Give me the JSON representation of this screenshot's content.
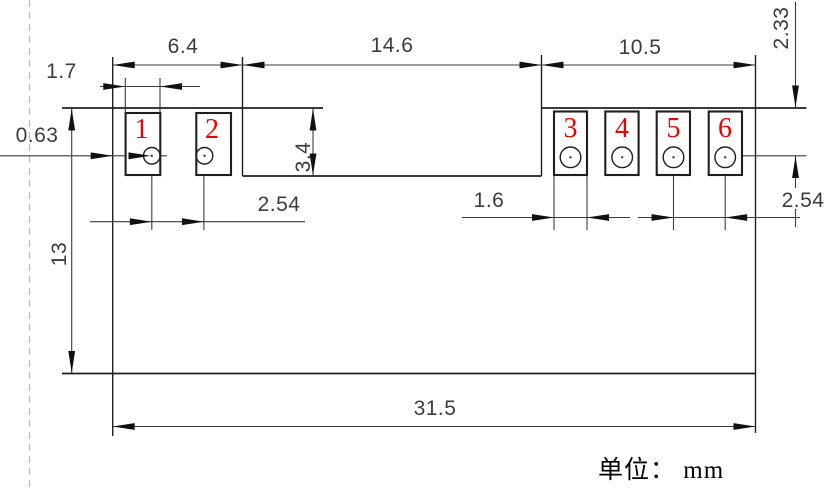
{
  "drawing": {
    "unit_note": "单位： mm",
    "canvas": {
      "w": 836,
      "h": 490,
      "bg": "#ffffff"
    },
    "colors": {
      "feature": "#1f1f1f",
      "dim": "#3c3c3c",
      "arrow": "#111111",
      "pad_number_red": "#ee0000",
      "dashed": "#b4b4b4",
      "text": "#3c3c3c"
    },
    "pads": [
      {
        "num": "1",
        "x": 125.6,
        "y": 113,
        "w": 34.7,
        "h": 62,
        "hole": {
          "cx": 151.8,
          "cy": 155.8,
          "r": 8.3
        },
        "num_x": 141.5,
        "num_y": 138
      },
      {
        "num": "2",
        "x": 196.3,
        "y": 113,
        "w": 34.7,
        "h": 62,
        "hole": {
          "cx": 204.5,
          "cy": 155.8,
          "r": 8.3
        },
        "num_x": 212,
        "num_y": 138
      },
      {
        "num": "3",
        "x": 554,
        "y": 111.5,
        "w": 33,
        "h": 63.5,
        "hole": {
          "cx": 570.5,
          "cy": 157.3,
          "r": 10.3
        },
        "num_x": 570.5,
        "num_y": 137
      },
      {
        "num": "4",
        "x": 605.3,
        "y": 111.5,
        "w": 33.3,
        "h": 63.5,
        "hole": {
          "cx": 622.2,
          "cy": 157.3,
          "r": 10.3
        },
        "num_x": 622,
        "num_y": 137
      },
      {
        "num": "5",
        "x": 656.7,
        "y": 111.5,
        "w": 33.3,
        "h": 63.5,
        "hole": {
          "cx": 673.5,
          "cy": 157.3,
          "r": 10.3
        },
        "num_x": 673.5,
        "num_y": 137
      },
      {
        "num": "6",
        "x": 708.7,
        "y": 111.5,
        "w": 33.3,
        "h": 63.5,
        "hole": {
          "cx": 725.2,
          "cy": 157.3,
          "r": 10.3
        },
        "num_x": 725,
        "num_y": 137
      }
    ],
    "lines": [
      {
        "n": "phantom-centerline",
        "x1": 29.5,
        "y1": 0,
        "x2": 29.5,
        "y2": 490,
        "w": 1,
        "c": "dashed",
        "dash": [
          7,
          5
        ]
      },
      {
        "n": "body-top-edge-left",
        "x1": 62,
        "y1": 108,
        "x2": 323,
        "y2": 108,
        "w": 1.7,
        "c": "feature"
      },
      {
        "n": "body-top-edge-right",
        "x1": 541.5,
        "y1": 108,
        "x2": 806.5,
        "y2": 108,
        "w": 1.7,
        "c": "feature"
      },
      {
        "n": "body-left-edge",
        "x1": 112.7,
        "y1": 57,
        "x2": 112.7,
        "y2": 436,
        "w": 1.4,
        "c": "feature"
      },
      {
        "n": "body-right-edge",
        "x1": 755.5,
        "y1": 55,
        "x2": 755.5,
        "y2": 433,
        "w": 1.4,
        "c": "feature"
      },
      {
        "n": "body-bottom-edge",
        "x1": 62,
        "y1": 373.5,
        "x2": 755.5,
        "y2": 373.5,
        "w": 1.7,
        "c": "feature"
      },
      {
        "n": "center-slot-left-edge",
        "x1": 242.5,
        "y1": 57,
        "x2": 242.5,
        "y2": 176,
        "w": 1.4,
        "c": "feature"
      },
      {
        "n": "center-slot-right-edge",
        "x1": 541.5,
        "y1": 55,
        "x2": 541.5,
        "y2": 176,
        "w": 1.4,
        "c": "feature"
      },
      {
        "n": "center-slot-bottom-edge",
        "x1": 242.5,
        "y1": 176,
        "x2": 541.5,
        "y2": 176,
        "w": 1.7,
        "c": "feature"
      },
      {
        "n": "dim-line-top-row",
        "x1": 112.7,
        "y1": 65,
        "x2": 755.5,
        "y2": 65,
        "w": 1.1,
        "c": "dim"
      },
      {
        "n": "dim-line-1.7",
        "x1": 100,
        "y1": 86.5,
        "x2": 200,
        "y2": 86.5,
        "w": 1.1,
        "c": "dim"
      },
      {
        "n": "ext-line-pad1-left",
        "x1": 125.3,
        "y1": 78,
        "x2": 125.3,
        "y2": 112,
        "w": 1.1,
        "c": "dim"
      },
      {
        "n": "ext-line-pad1-right",
        "x1": 160,
        "y1": 78,
        "x2": 160,
        "y2": 112,
        "w": 1.1,
        "c": "dim"
      },
      {
        "n": "leader-line-0.63",
        "x1": 0,
        "y1": 155.8,
        "x2": 167,
        "y2": 155.8,
        "w": 1.1,
        "c": "dim"
      },
      {
        "n": "hole6-center-hline",
        "x1": 725,
        "y1": 155.8,
        "x2": 806.5,
        "y2": 155.8,
        "w": 1.1,
        "c": "dim"
      },
      {
        "n": "dim-line-2.33",
        "x1": 795.5,
        "y1": 2,
        "x2": 795.5,
        "y2": 107.5,
        "w": 1.1,
        "c": "dim"
      },
      {
        "n": "dim-line-2.54-right-a",
        "x1": 795.5,
        "y1": 156,
        "x2": 795.5,
        "y2": 188,
        "w": 1.1,
        "c": "dim"
      },
      {
        "n": "dim-line-2.54-right-b",
        "x1": 795.5,
        "y1": 209,
        "x2": 795.5,
        "y2": 227,
        "w": 1.1,
        "c": "dim"
      },
      {
        "n": "dim-line-13",
        "x1": 71.7,
        "y1": 108.5,
        "x2": 71.7,
        "y2": 373,
        "w": 1.1,
        "c": "dim"
      },
      {
        "n": "dim-line-3.4",
        "x1": 313,
        "y1": 108,
        "x2": 313,
        "y2": 175.5,
        "w": 1.1,
        "c": "dim"
      },
      {
        "n": "dim-line-2.54-left",
        "x1": 90,
        "y1": 221.7,
        "x2": 305,
        "y2": 221.7,
        "w": 1.1,
        "c": "dim"
      },
      {
        "n": "hole1-centerline",
        "x1": 151.8,
        "y1": 147,
        "x2": 151.8,
        "y2": 230,
        "w": 1.1,
        "c": "dim"
      },
      {
        "n": "hole2-centerline",
        "x1": 203.9,
        "y1": 147,
        "x2": 203.9,
        "y2": 230,
        "w": 1.1,
        "c": "dim"
      },
      {
        "n": "dim-line-1.6",
        "x1": 462,
        "y1": 217.5,
        "x2": 630,
        "y2": 217.5,
        "w": 1.1,
        "c": "dim"
      },
      {
        "n": "ext-line-pad3-left",
        "x1": 554,
        "y1": 176,
        "x2": 554,
        "y2": 230,
        "w": 1.1,
        "c": "dim"
      },
      {
        "n": "ext-line-pad3-right",
        "x1": 587,
        "y1": 176,
        "x2": 587,
        "y2": 230,
        "w": 1.1,
        "c": "dim"
      },
      {
        "n": "dim-line-2.54-pitch",
        "x1": 638,
        "y1": 217.5,
        "x2": 800,
        "y2": 217.5,
        "w": 1.1,
        "c": "dim"
      },
      {
        "n": "hole5-centerline",
        "x1": 673.5,
        "y1": 170,
        "x2": 673.5,
        "y2": 230,
        "w": 1.1,
        "c": "dim"
      },
      {
        "n": "hole6-centerline",
        "x1": 725.2,
        "y1": 170,
        "x2": 725.2,
        "y2": 230,
        "w": 1.1,
        "c": "dim"
      },
      {
        "n": "dim-line-31.5",
        "x1": 112.7,
        "y1": 426.5,
        "x2": 755.5,
        "y2": 426.5,
        "w": 1.1,
        "c": "dim"
      }
    ],
    "arrows": [
      {
        "n": "arrow-6.4-left",
        "x": 112.7,
        "y": 65,
        "dir": "l"
      },
      {
        "n": "arrow-6.4-right",
        "x": 242.5,
        "y": 65,
        "dir": "r"
      },
      {
        "n": "arrow-14.6-left",
        "x": 242.5,
        "y": 65,
        "dir": "l"
      },
      {
        "n": "arrow-14.6-right",
        "x": 541.5,
        "y": 65,
        "dir": "r"
      },
      {
        "n": "arrow-10.5-left",
        "x": 541.5,
        "y": 65,
        "dir": "l"
      },
      {
        "n": "arrow-10.5-right",
        "x": 755.5,
        "y": 65,
        "dir": "r"
      },
      {
        "n": "arrow-1.7-left",
        "x": 125.3,
        "y": 86.5,
        "dir": "r"
      },
      {
        "n": "arrow-1.7-right",
        "x": 160,
        "y": 86.5,
        "dir": "l"
      },
      {
        "n": "arrow-0.63-a",
        "x": 112.7,
        "y": 155.8,
        "dir": "r"
      },
      {
        "n": "arrow-0.63-b",
        "x": 150.5,
        "y": 155.8,
        "dir": "r"
      },
      {
        "n": "arrow-2.33-down",
        "x": 795.5,
        "y": 107.5,
        "dir": "d"
      },
      {
        "n": "arrow-2.54-right-up",
        "x": 795.5,
        "y": 156,
        "dir": "u"
      },
      {
        "n": "arrow-13-top",
        "x": 71.7,
        "y": 108.5,
        "dir": "u"
      },
      {
        "n": "arrow-13-bottom",
        "x": 71.7,
        "y": 373,
        "dir": "d"
      },
      {
        "n": "arrow-3.4-top",
        "x": 313,
        "y": 108.5,
        "dir": "u"
      },
      {
        "n": "arrow-3.4-bottom",
        "x": 313,
        "y": 175.5,
        "dir": "d"
      },
      {
        "n": "arrow-2.54-left-a",
        "x": 151.8,
        "y": 221.7,
        "dir": "r"
      },
      {
        "n": "arrow-2.54-left-b",
        "x": 203.9,
        "y": 221.7,
        "dir": "r"
      },
      {
        "n": "arrow-1.6-left",
        "x": 554,
        "y": 217.5,
        "dir": "r"
      },
      {
        "n": "arrow-1.6-right",
        "x": 587,
        "y": 217.5,
        "dir": "l"
      },
      {
        "n": "arrow-2.54-pitch-left",
        "x": 673.5,
        "y": 217.5,
        "dir": "r"
      },
      {
        "n": "arrow-2.54-pitch-right",
        "x": 725.2,
        "y": 217.5,
        "dir": "l"
      },
      {
        "n": "arrow-31.5-left",
        "x": 112.7,
        "y": 426.5,
        "dir": "l"
      },
      {
        "n": "arrow-31.5-right",
        "x": 755.5,
        "y": 426.5,
        "dir": "r"
      }
    ],
    "labels": [
      {
        "n": "dim-label-6.4",
        "t": "6.4",
        "x": 183,
        "y": 53,
        "rot": 0,
        "s": 21
      },
      {
        "n": "dim-label-14.6",
        "t": "14.6",
        "x": 392,
        "y": 52,
        "rot": 0,
        "s": 21
      },
      {
        "n": "dim-label-10.5",
        "t": "10.5",
        "x": 640,
        "y": 54,
        "rot": 0,
        "s": 21
      },
      {
        "n": "dim-label-1.7",
        "t": "1.7",
        "x": 61.5,
        "y": 78,
        "rot": 0,
        "s": 21
      },
      {
        "n": "dim-label-0.63",
        "t": "0.63",
        "x": 37,
        "y": 142,
        "rot": 0,
        "s": 21
      },
      {
        "n": "dim-label-2.33",
        "t": "2.33",
        "x": 788,
        "y": 28,
        "rot": -90,
        "s": 21
      },
      {
        "n": "dim-label-13",
        "t": "13",
        "x": 66,
        "y": 254,
        "rot": -90,
        "s": 21
      },
      {
        "n": "dim-label-3.4",
        "t": "3.4",
        "x": 310,
        "y": 157,
        "rot": -90,
        "s": 21
      },
      {
        "n": "dim-label-2.54-left",
        "t": "2.54",
        "x": 279,
        "y": 211,
        "rot": 0,
        "s": 21
      },
      {
        "n": "dim-label-1.6",
        "t": "1.6",
        "x": 489,
        "y": 207,
        "rot": 0,
        "s": 21
      },
      {
        "n": "dim-label-2.54-right",
        "t": "2.54",
        "x": 803,
        "y": 207,
        "rot": 0,
        "s": 21
      },
      {
        "n": "dim-label-31.5",
        "t": "31.5",
        "x": 435,
        "y": 415,
        "rot": 0,
        "s": 21
      }
    ]
  }
}
